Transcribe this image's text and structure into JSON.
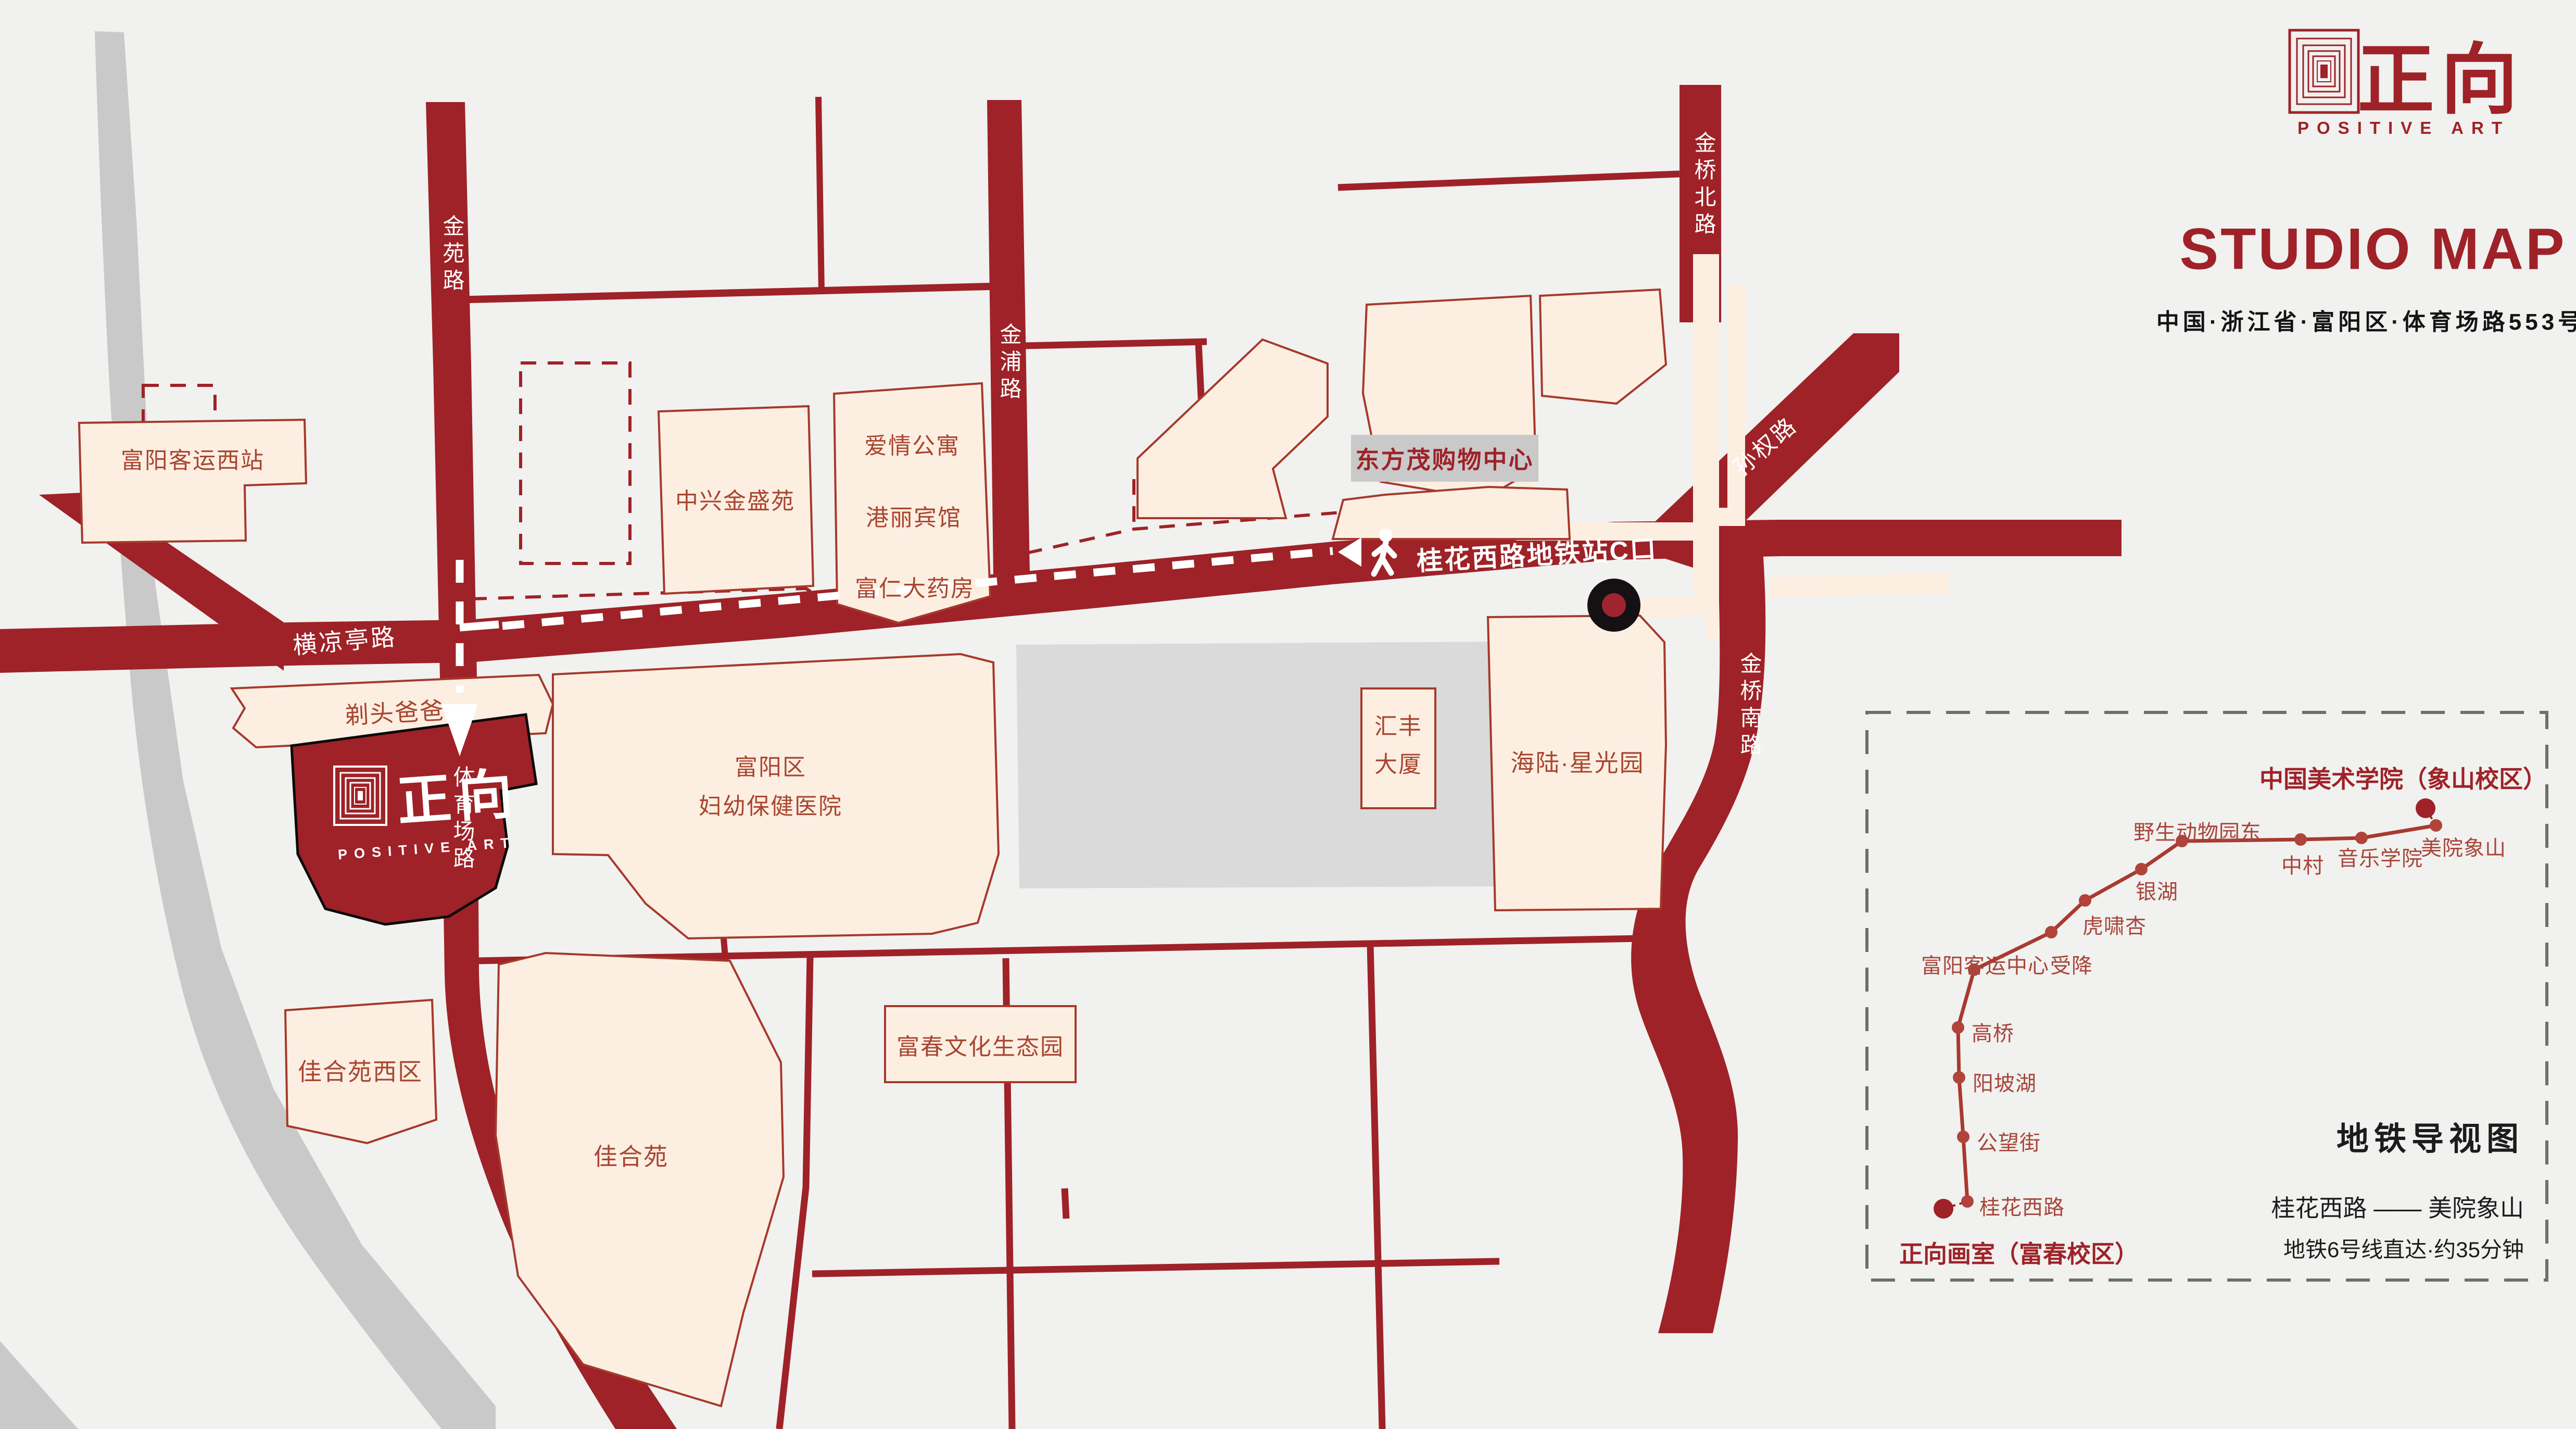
{
  "header": {
    "logo_zh": "正向",
    "logo_en": "POSITIVE ART",
    "title": "STUDIO MAP",
    "address": "中国·浙江省·富阳区·体育场路553号"
  },
  "studio": {
    "logo_zh": "正向",
    "logo_en": "POSITIVE ART"
  },
  "roads": {
    "jinyuan": "金苑路",
    "tiyuchang": "体育场路",
    "hengliangting": "横凉亭路",
    "jinpu": "金浦路",
    "jinqiao_north": "金桥北路",
    "jinqiao_south": "金桥南路",
    "sunquan": "孙权路"
  },
  "route": {
    "metro_exit": "桂花西路地铁站C口"
  },
  "buildings": {
    "fuyang_west_station": "富阳客运西站",
    "zhongxing": "中兴金盛苑",
    "aiqing": "爱情公寓",
    "gangli": "港丽宾馆",
    "furen": "富仁大药房",
    "dongfangmao": "东方茂购物中心",
    "huifeng_1": "汇丰",
    "huifeng_2": "大厦",
    "hailu": "海陆·星光园",
    "hospital_1": "富阳区",
    "hospital_2": "妇幼保健医院",
    "titou": "剃头爸爸",
    "jiaheyuan_west": "佳合苑西区",
    "jiaheyuan": "佳合苑",
    "fuchun_park": "富春文化生态园"
  },
  "metro": {
    "panel_title": "地铁导视图",
    "origin": "正向画室（富春校区）",
    "destination": "中国美术学院（象山校区）",
    "route_desc": "桂花西路 —— 美院象山",
    "duration": "地铁6号线直达·约35分钟",
    "stations": [
      "桂花西路",
      "公望街",
      "阳坡湖",
      "高桥",
      "富阳客运中心",
      "受降",
      "虎啸杏",
      "银湖",
      "野生动物园东",
      "中村",
      "音乐学院",
      "美院象山"
    ]
  },
  "colors": {
    "road": "#9e2227",
    "accent": "#9e2228",
    "building_fill": "#fdeee2",
    "building_stroke": "#a5392c",
    "label_text": "#a8462f",
    "panel_black": "#1c1c1c",
    "gray_river": "#c9c9c9"
  }
}
